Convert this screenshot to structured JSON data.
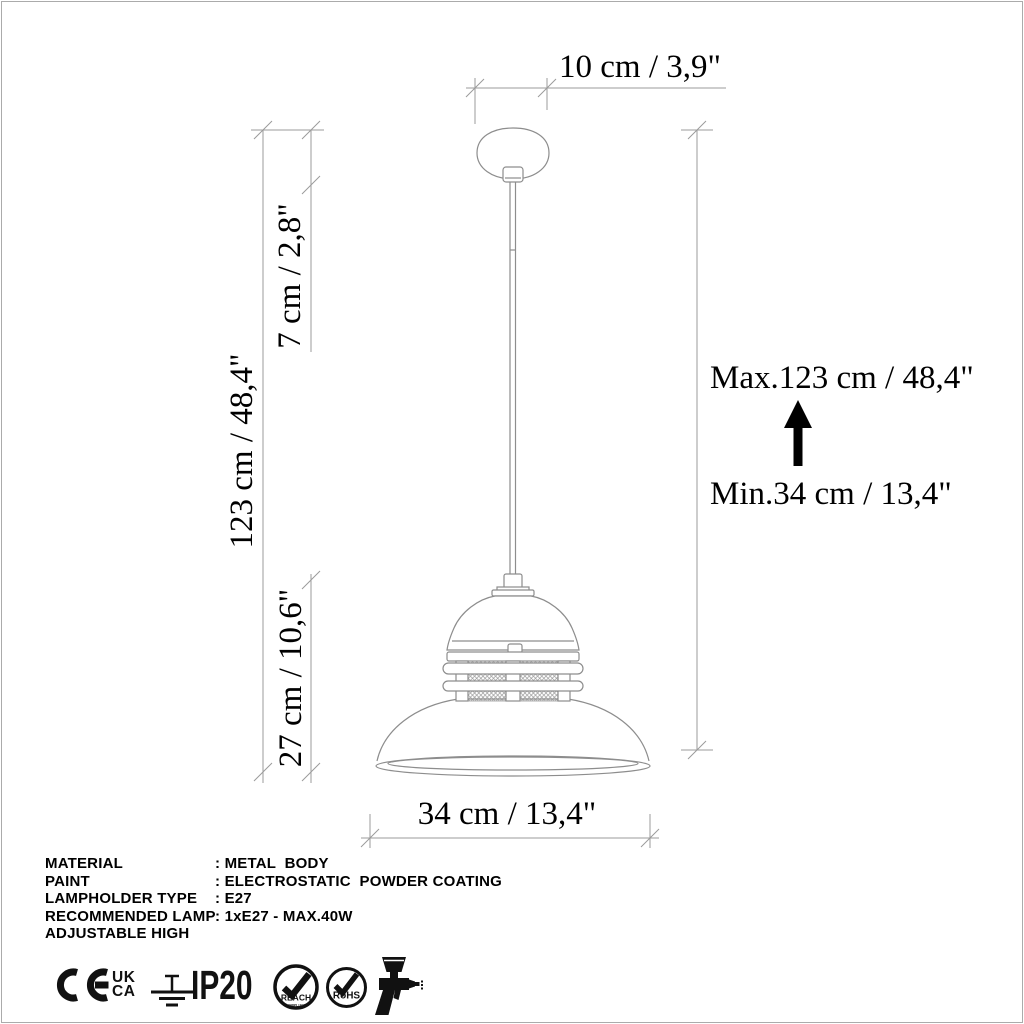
{
  "dimensions": {
    "top": "10 cm / 3,9\"",
    "left_total": "123 cm / 48,4\"",
    "left_canopy": "7 cm / 2,8\"",
    "left_shade": "27 cm / 10,6\"",
    "right_max": "Max.123 cm / 48,4\"",
    "right_min": "Min.34 cm / 13,4\"",
    "bottom_width": "34 cm / 13,4\""
  },
  "specs": {
    "rows": [
      {
        "label": "MATERIAL",
        "value": ": METAL  BODY"
      },
      {
        "label": "PAINT",
        "value": ": ELECTROSTATIC  POWDER COATING"
      },
      {
        "label": "LAMPHOLDER TYPE",
        "value": ": E27"
      },
      {
        "label": "RECOMMENDED LAMP",
        "value": ": 1xE27 - MAX.40W"
      },
      {
        "label": "ADJUSTABLE HIGH",
        "value": ""
      }
    ]
  },
  "certifications": {
    "ukca_top": "UK",
    "ukca_bottom": "CA",
    "ip_rating": "IP20",
    "reach_label": "REACH",
    "reach_sublabel": "COMPLIANT",
    "rohs_label": "RoHS",
    "icon_names": [
      "ce-mark",
      "ukca-mark",
      "earth-ground-symbol",
      "ip20-rating",
      "reach-compliant-badge",
      "rohs-badge",
      "spray-gun-icon"
    ]
  },
  "colors": {
    "drawing_line": "#8d8d8d",
    "dimension_line": "#9b9b9b",
    "text": "#000000",
    "frame_border": "#ababab",
    "icon_black": "#111111"
  }
}
